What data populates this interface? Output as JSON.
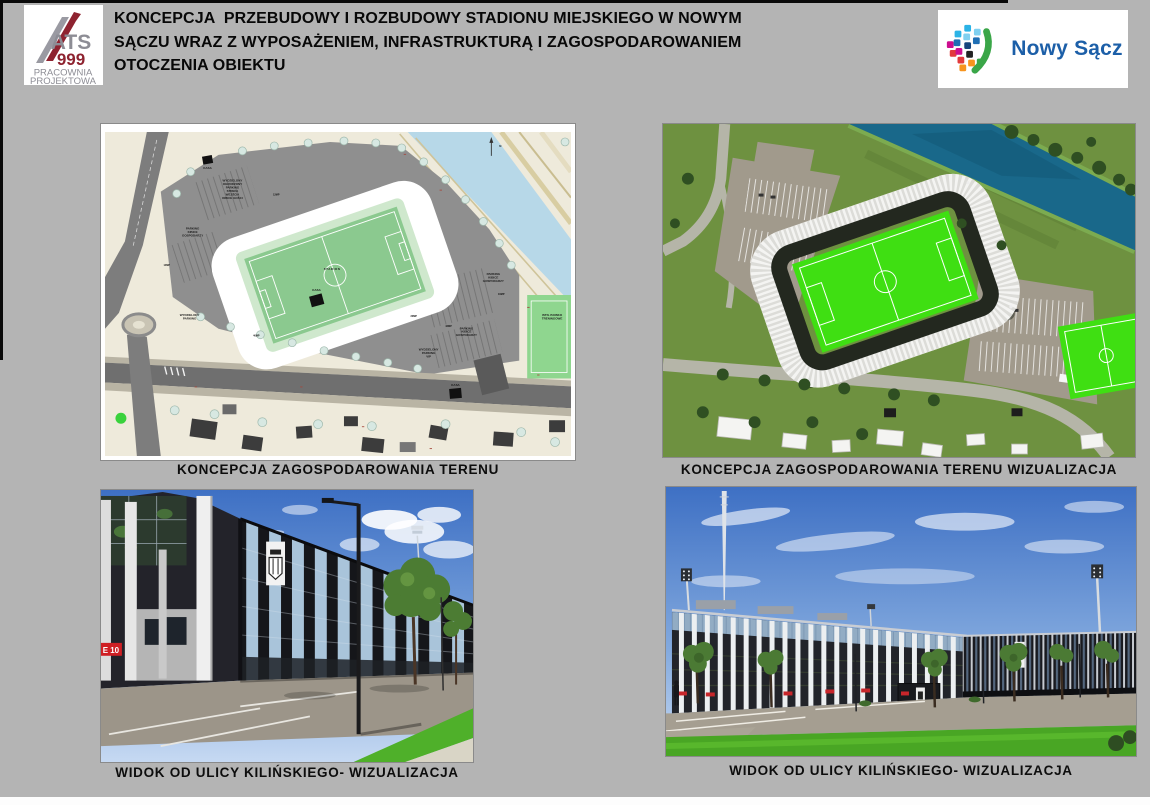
{
  "header": {
    "title": "KONCEPCJA  PRZEBUDOWY I ROZBUDOWY STADIONU MIEJSKIEGO W NOWYM\nSĄCZU WRAZ Z WYPOSAŻENIEM, INFRASTRUKTURĄ I ZAGOSPODAROWANIEM\nOTOCZENIA OBIEKTU",
    "ats_logo": {
      "acronym": "ATS",
      "number": "999",
      "subtitle_line1": "PRACOWNIA",
      "subtitle_line2": "PROJEKTOWA",
      "accent_color": "#8e2330",
      "gray_color": "#8d8d95"
    },
    "city_logo": {
      "name": "Nowy Sącz",
      "text_color": "#1c5fa8"
    }
  },
  "panels": {
    "site_plan": {
      "caption": "KONCEPCJA ZAGOSPODAROWANIA TERENU",
      "labels": {
        "stadium": "STADION",
        "kasa": "KASA",
        "north": "N",
        "away_parking_lines": [
          "WYDZIELONY",
          "OGRODZONY",
          "PARKING",
          "STREFA",
          "WEJŚCIA",
          "KIBICE GOŚCI"
        ],
        "home_parking_lines": [
          "PARKING",
          "KIBICE",
          "GOSPODARZY"
        ],
        "side_parking_lines": [
          "WYDZIELONY",
          "PARKING"
        ],
        "vip_parking_lines": [
          "WYDZIELONY",
          "PARKING",
          "VIP"
        ],
        "training_lines": [
          "ISTN. BOISKO",
          "TRENINGOWE"
        ],
        "parking_codes": [
          "14MP",
          "12MP",
          "20MP",
          "42MP",
          "16MP",
          "40MP"
        ]
      }
    },
    "site_plan_viz": {
      "caption": "KONCEPCJA ZAGOSPODAROWANIA TERENU WIZUALIZACJA"
    },
    "street_view_1": {
      "caption": "WIDOK OD ULICY KILIŃSKIEGO- WIZUALIZACJA",
      "gate_sign": "E 10"
    },
    "street_view_2": {
      "caption": "WIDOK OD ULICY KILIŃSKIEGO- WIZUALIZACJA"
    }
  },
  "colors": {
    "page_bg": "#b4b4b4",
    "caption_text": "#0d0d0d",
    "accent_red": "#c8262b",
    "map_bg": "#eeeadb",
    "map_river": "#b7d8e8",
    "map_pitch": "#8bc98f",
    "viz_grass": "#6e9140",
    "viz_river": "#19688a",
    "viz_pitch": "#3fdf12",
    "sky_top": "#3e70c4",
    "sky_horizon": "#c6d9f2"
  }
}
